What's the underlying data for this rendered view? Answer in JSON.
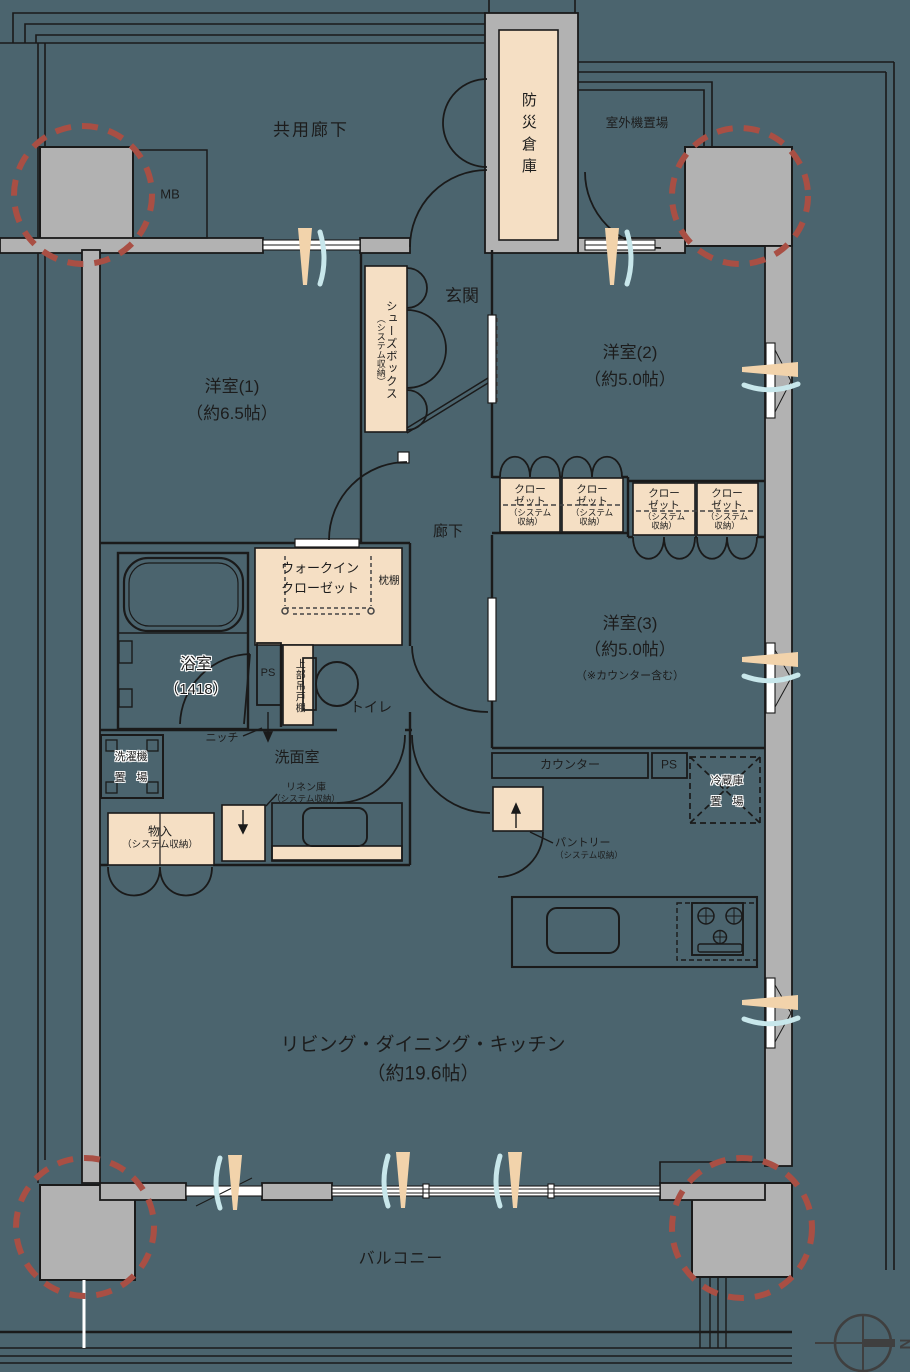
{
  "colors": {
    "background": "#4b646e",
    "wall_gray": "#b2b2b2",
    "line": "#1a1a1a",
    "storage_beige": "#f5dfc4",
    "vent_beige": "#f2d3ab",
    "vent_blue": "#c8e7eb",
    "accent_red": "#a94f44",
    "compass": "#3f3f3f"
  },
  "exterior": {
    "common_corridor": "共用廊下",
    "meter_box": "MB",
    "disaster_storage": "防災倉庫",
    "outdoor_unit_area": "室外機置場",
    "balcony": "バルコニー",
    "compass_north": "N"
  },
  "entrance": {
    "genkan": "玄関",
    "shoe_box": "シューズボックス",
    "shoe_box_sub": "（システム収納）"
  },
  "rooms": {
    "room1": {
      "name": "洋室(1)",
      "size": "（約6.5帖）"
    },
    "room2": {
      "name": "洋室(2)",
      "size": "（約5.0帖）"
    },
    "room3": {
      "name": "洋室(3)",
      "size": "（約5.0帖）",
      "note": "（※カウンター含む）"
    },
    "ldk": {
      "name": "リビング・ダイニング・キッチン",
      "size": "（約19.6帖）"
    },
    "hallway": "廊下",
    "washroom": "洗面室",
    "bathroom": {
      "name": "浴室",
      "size": "（1418）"
    },
    "toilet": "トイレ"
  },
  "storage": {
    "closet": {
      "l1": "クロー",
      "l2": "ゼット",
      "l3": "（システム",
      "l4": "収納）"
    },
    "wic": {
      "l1": "ウォークイン",
      "l2": "クローゼット"
    },
    "pillow_shelf": "枕棚",
    "upper_cabinet": "上部吊戸棚",
    "linen": {
      "l1": "リネン庫",
      "l2": "（システム収納）"
    },
    "storage_closet": {
      "l1": "物入",
      "l2": "（システム収納）"
    },
    "pantry": {
      "l1": "パントリー",
      "l2": "（システム収納）"
    }
  },
  "fixtures": {
    "ps": "PS",
    "niche": "ニッチ",
    "counter": "カウンター",
    "laundry": {
      "l1": "洗濯機",
      "l2": "置　場"
    },
    "fridge": {
      "l1": "冷蔵庫",
      "l2": "置　場"
    }
  }
}
